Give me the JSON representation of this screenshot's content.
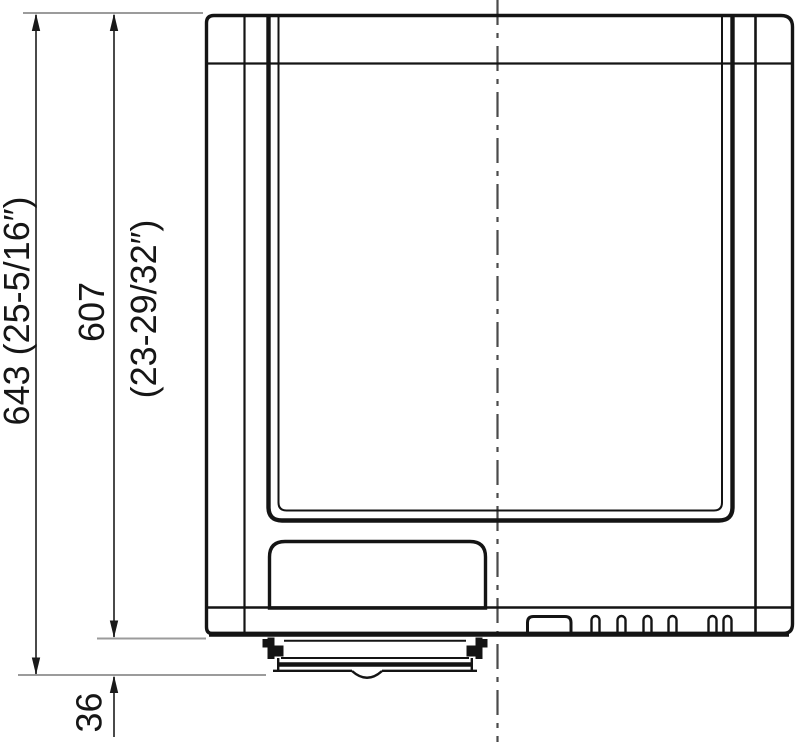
{
  "drawing": {
    "kind": "technical-dimension-drawing",
    "dimensions": {
      "overall_height": {
        "label": "643 (25-5/16″)"
      },
      "cabinet_height": {
        "label_mm": "607",
        "label_in": "(23-29/32″)"
      },
      "base_height": {
        "label": "36"
      }
    },
    "colors": {
      "outline": "#141414",
      "dimension_line": "#4a4a4a",
      "extension_line": "#9b9b9b",
      "centerline": "#4a4a4a",
      "background": "#ffffff"
    }
  }
}
